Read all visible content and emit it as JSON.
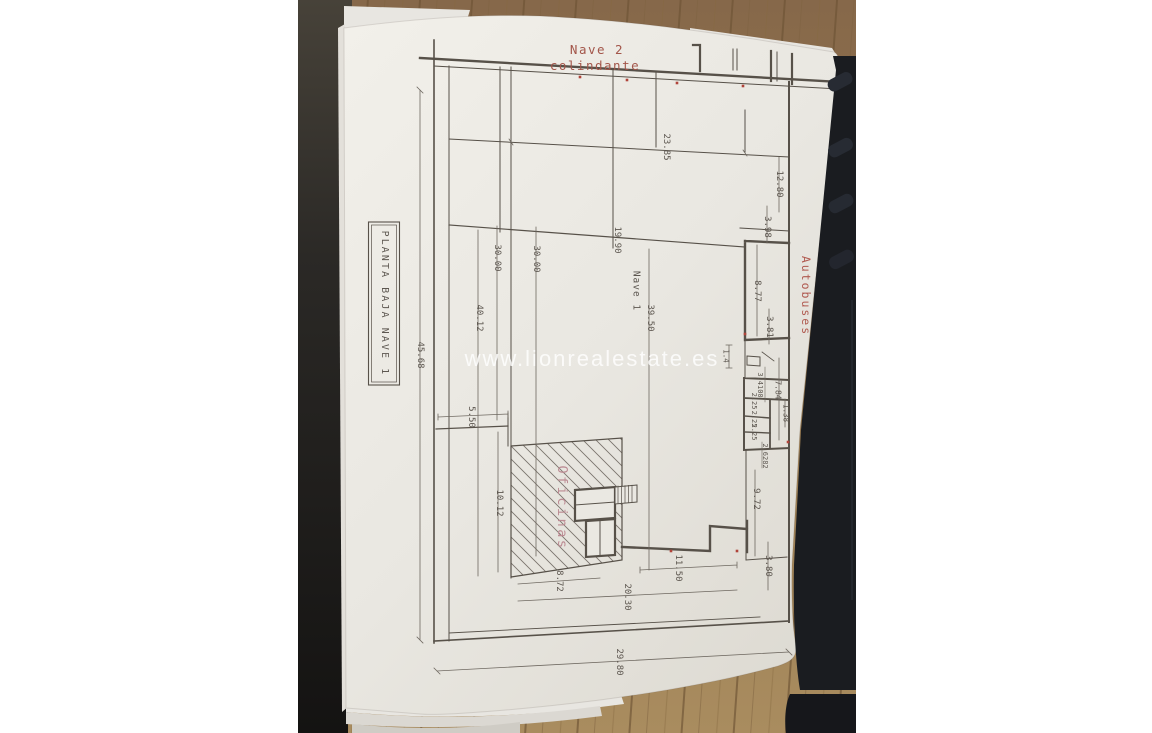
{
  "watermark": "www.lionrealestate.es",
  "plan": {
    "title_box": "PLANTA BAJA NAVE 1",
    "neighbor_label": {
      "line1": "Nave 2",
      "line2": "colindante"
    },
    "rooms": {
      "autobuses": "Autobuses",
      "oficinas": "Oficinas",
      "nave1": "Nave 1"
    },
    "dimensions": {
      "d45_68": "45.68",
      "d23_85": "23.85",
      "d12_80": "12.80",
      "d3_98": "3.98",
      "d19_90": "19.90",
      "d30_00_a": "30.00",
      "d30_00_b": "30.00",
      "d40_12": "40.12",
      "d39_50": "39.50",
      "d8_77": "8.77",
      "d3_81": "3.81",
      "d1_4": "1.4",
      "d7_84": "7.84",
      "d1_38": "1.38",
      "d3_4100": "3.4100",
      "d2_25_a": "2.25",
      "d2_25_b": "2.25",
      "d2_25_c": "2.25",
      "d2_6282": "2.6282",
      "d9_72": "9.72",
      "d5_50": "5.50",
      "d10_12": "10.12",
      "d8_72": "8.72",
      "d11_50": "11.50",
      "d3_80": "3.80",
      "d20_30": "20.30",
      "d29_80": "29.80"
    }
  },
  "colors": {
    "red_annotation": "#a3564a",
    "autobuses_label": "#b05a50",
    "oficinas_label": "#bc8b93",
    "plan_line": "#575149",
    "paper": "#eae8e2",
    "wood_floor": "#96784f",
    "watermark_text": "rgba(255,255,255,0.8)"
  }
}
